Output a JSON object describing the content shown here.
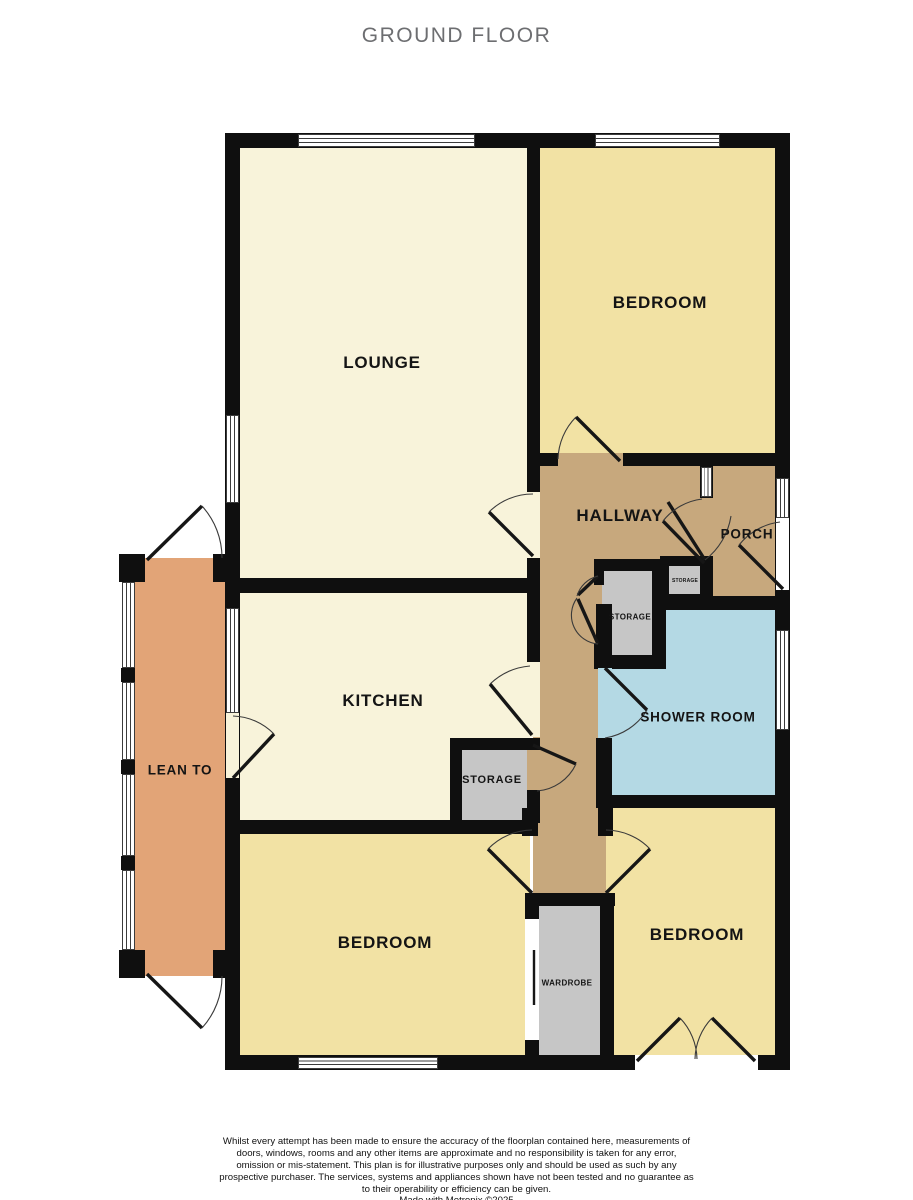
{
  "title": "GROUND FLOOR",
  "rooms": {
    "lounge": {
      "label": "LOUNGE"
    },
    "bedroom_top_right": {
      "label": "BEDROOM"
    },
    "hallway": {
      "label": "HALLWAY"
    },
    "porch": {
      "label": "PORCH"
    },
    "kitchen": {
      "label": "KITCHEN"
    },
    "shower_room": {
      "label": "SHOWER ROOM"
    },
    "lean_to": {
      "label": "LEAN TO"
    },
    "storage_hall": {
      "label": "STORAGE"
    },
    "storage_small": {
      "label": "STORAGE"
    },
    "storage_kitchen": {
      "label": "STORAGE"
    },
    "wardrobe": {
      "label": "WARDROBE"
    },
    "bedroom_bottom_left": {
      "label": "BEDROOM"
    },
    "bedroom_bottom_right": {
      "label": "BEDROOM"
    }
  },
  "footer": {
    "disclaimer": "Whilst every attempt has been made to ensure the accuracy of the floorplan contained here, measurements of doors, windows, rooms and any other items are approximate and no responsibility is taken for any error, omission or mis-statement. This plan is for illustrative purposes only and should be used as such by any prospective purchaser. The services, systems and appliances shown have not been tested and no guarantee as to their operability or efficiency can be given.",
    "credit": "Made with Metropix ©2025"
  },
  "colors": {
    "wall": "#0f0f0f",
    "cream": "#f8f3da",
    "yellow": "#f2e2a4",
    "tan": "#c7a87d",
    "orange": "#e2a477",
    "blue": "#b4d9e4",
    "gray": "#c6c6c6",
    "titlegray": "#6d6e71"
  }
}
